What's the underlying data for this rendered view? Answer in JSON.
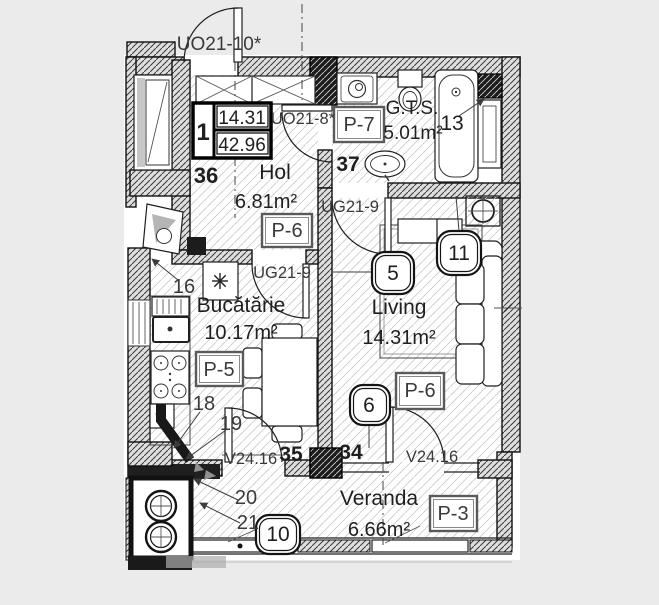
{
  "background": "#ebebeb",
  "ink": "#1f1f1f",
  "plan": {
    "unit_table": {
      "unit": "1",
      "living_area": "14.31",
      "total_area": "42.96"
    },
    "rooms": {
      "hol": {
        "number": "36",
        "name": "Hol",
        "area": "6.81m²",
        "finish": "P-6"
      },
      "gts": {
        "number": "37",
        "name": "G.T.S.",
        "area": "5.01m²",
        "finish": "P-7"
      },
      "kitchen": {
        "number": "35",
        "name": "Bucătărie",
        "area": "10.17m²",
        "finish": "P-5"
      },
      "living": {
        "number": "34",
        "name": "Living",
        "area": "14.31m²",
        "finish": "P-6"
      },
      "veranda": {
        "name": "Veranda",
        "area": "6.66m²",
        "finish": "P-3"
      }
    },
    "openings": {
      "entrance_door": "UO21-10*",
      "bathroom_door": "UO21-8*",
      "living_door": "UG21-9",
      "kitchen_door": "UG21-9",
      "kitchen_veranda_window": "V24.16",
      "living_veranda_window": "V24.16"
    },
    "callouts": {
      "c5": "5",
      "c6": "6",
      "c10": "10",
      "c11": "11",
      "c13": "13"
    },
    "leaders": {
      "n16": "16",
      "n18": "18",
      "n19": "19",
      "n20": "20",
      "n21": "21"
    }
  }
}
